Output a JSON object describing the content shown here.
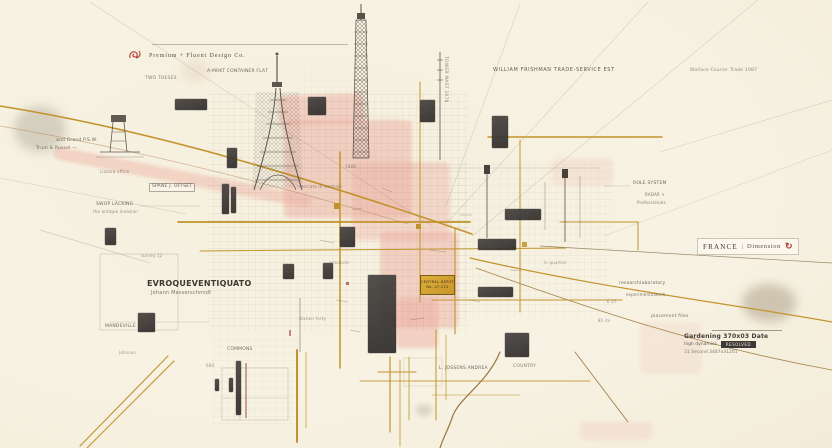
{
  "colors": {
    "paper": "#f7f1e1",
    "gold": "#c2932c",
    "gold_bright": "#d9a62e",
    "pink": "#eeb0a4",
    "charcoal": "#3c3936",
    "ink": "#4a443c",
    "red": "#b23a32"
  },
  "legend": {
    "text": "Premium + Fluent Design Co.",
    "icon": "rose-compass"
  },
  "region_tag": {
    "name": "FRANCE",
    "separator": "|",
    "label": "Dimension",
    "icon_glyph": "↻"
  },
  "plaque": {
    "line1": "CENTRAL DEPOT",
    "line2": "No. 47-212"
  },
  "info_block": {
    "title": "Gardening 370x03 Date",
    "subtitle": "high dynamics",
    "badge": "RESOLVED",
    "footer": "31 Second 3487x31201"
  },
  "labels": [
    {
      "text": "A-MRKT CONTAINER FLAT",
      "x": 207,
      "y": 70,
      "fs": 4.5,
      "op": 0.8
    },
    {
      "text": "TWO THESES",
      "x": 145,
      "y": 77,
      "fs": 4.5,
      "op": 0.65
    },
    {
      "text": "and Grand P.S.W.",
      "x": 56,
      "y": 139,
      "fs": 4.5,
      "op": 0.8
    },
    {
      "text": "Trum & Russel —",
      "x": 36,
      "y": 147,
      "fs": 4.5,
      "op": 0.75
    },
    {
      "text": "Lizzard office",
      "x": 100,
      "y": 170,
      "fs": 4,
      "op": 0.6
    },
    {
      "text": "SPANE J. OFFSET",
      "x": 149,
      "y": 183,
      "fs": 4.5,
      "op": 0.85,
      "boxed": true
    },
    {
      "text": "SWOP LACKING",
      "x": 96,
      "y": 203,
      "fs": 4.5,
      "op": 0.8
    },
    {
      "text": "the antique invasion",
      "x": 93,
      "y": 210,
      "fs": 4,
      "op": 0.6
    },
    {
      "text": "WILLIAM FRISHMAN TRADE-SERVICE EST",
      "x": 493,
      "y": 68,
      "fs": 5,
      "ls": 0.6,
      "op": 0.85
    },
    {
      "text": "Wallace Courier Trade 1987",
      "x": 690,
      "y": 69,
      "fs": 4.5,
      "op": 0.6
    },
    {
      "text": "ROLE SYSTEM",
      "x": 633,
      "y": 182,
      "fs": 4.5,
      "op": 0.8
    },
    {
      "text": "RADAR +",
      "x": 645,
      "y": 193,
      "fs": 4,
      "op": 0.7
    },
    {
      "text": "Professionals",
      "x": 637,
      "y": 201,
      "fs": 4,
      "op": 0.65
    },
    {
      "text": "EVROQUEVENTIQUATO",
      "x": 147,
      "y": 280,
      "fs": 8,
      "bold": true,
      "ls": 0.2,
      "color": "#3e3832"
    },
    {
      "text": "Johann Messerschmidt",
      "x": 151,
      "y": 291,
      "fs": 5,
      "op": 0.7
    },
    {
      "text": "survey 12",
      "x": 141,
      "y": 254,
      "fs": 4,
      "op": 0.55
    },
    {
      "text": "MANDEVILLE ST",
      "x": 105,
      "y": 325,
      "fs": 4.5,
      "op": 0.8
    },
    {
      "text": "Johnson",
      "x": 119,
      "y": 351,
      "fs": 4,
      "op": 0.5
    },
    {
      "text": "COMMONS",
      "x": 227,
      "y": 348,
      "fs": 4.5,
      "op": 0.75
    },
    {
      "text": "600",
      "x": 206,
      "y": 364,
      "fs": 4,
      "op": 0.55
    },
    {
      "text": "L. JOSSENS ANDREA",
      "x": 439,
      "y": 367,
      "fs": 4.5,
      "op": 0.8
    },
    {
      "text": "COUNTRY",
      "x": 513,
      "y": 365,
      "fs": 4.5,
      "op": 0.65
    },
    {
      "text": "researchlaboratory",
      "x": 619,
      "y": 282,
      "fs": 4.5,
      "op": 0.8
    },
    {
      "text": "experimentalwork",
      "x": 626,
      "y": 293,
      "fs": 4,
      "op": 0.7
    },
    {
      "text": "E 27",
      "x": 607,
      "y": 300,
      "fs": 4,
      "op": 0.55
    },
    {
      "text": "placement files",
      "x": 651,
      "y": 315,
      "fs": 4.5,
      "op": 0.75
    },
    {
      "text": "81 mi",
      "x": 598,
      "y": 319,
      "fs": 4,
      "op": 0.55
    },
    {
      "text": "TOWER MAST 1978",
      "x": 447,
      "y": 56,
      "fs": 4.5,
      "rot": 90,
      "op": 0.6
    },
    {
      "text": "mercato di centrale",
      "x": 299,
      "y": 185,
      "fs": 4,
      "op": 0.55
    },
    {
      "text": "armature",
      "x": 329,
      "y": 261,
      "fs": 4,
      "op": 0.5
    },
    {
      "text": "station forty",
      "x": 299,
      "y": 317,
      "fs": 4,
      "op": 0.5
    },
    {
      "text": "le quartier",
      "x": 544,
      "y": 261,
      "fs": 4,
      "op": 0.5
    },
    {
      "text": "1888",
      "x": 345,
      "y": 165,
      "fs": 4,
      "op": 0.55
    }
  ],
  "blocks": [
    {
      "x": 175,
      "y": 99,
      "w": 32,
      "h": 11
    },
    {
      "x": 308,
      "y": 97,
      "w": 18,
      "h": 18
    },
    {
      "x": 420,
      "y": 100,
      "w": 15,
      "h": 22
    },
    {
      "x": 492,
      "y": 116,
      "w": 16,
      "h": 32
    },
    {
      "x": 227,
      "y": 148,
      "w": 10,
      "h": 20
    },
    {
      "x": 222,
      "y": 184,
      "w": 7,
      "h": 30
    },
    {
      "x": 231,
      "y": 187,
      "w": 5,
      "h": 26
    },
    {
      "x": 340,
      "y": 227,
      "w": 15,
      "h": 20
    },
    {
      "x": 505,
      "y": 209,
      "w": 36,
      "h": 11
    },
    {
      "x": 478,
      "y": 239,
      "w": 38,
      "h": 11
    },
    {
      "x": 478,
      "y": 287,
      "w": 35,
      "h": 10
    },
    {
      "x": 283,
      "y": 264,
      "w": 11,
      "h": 15
    },
    {
      "x": 323,
      "y": 263,
      "w": 10,
      "h": 16
    },
    {
      "x": 368,
      "y": 275,
      "w": 28,
      "h": 78
    },
    {
      "x": 505,
      "y": 333,
      "w": 24,
      "h": 24
    },
    {
      "x": 105,
      "y": 228,
      "w": 11,
      "h": 17
    },
    {
      "x": 138,
      "y": 313,
      "w": 17,
      "h": 19
    },
    {
      "x": 236,
      "y": 361,
      "w": 5,
      "h": 54
    },
    {
      "x": 229,
      "y": 378,
      "w": 4,
      "h": 14
    },
    {
      "x": 215,
      "y": 379,
      "w": 4,
      "h": 12
    }
  ],
  "patches": [
    {
      "x": 278,
      "y": 96,
      "w": 86,
      "h": 30,
      "rot": -2,
      "op": 0.5
    },
    {
      "x": 284,
      "y": 120,
      "w": 128,
      "h": 98,
      "rot": 0,
      "op": 0.5
    },
    {
      "x": 352,
      "y": 162,
      "w": 98,
      "h": 78,
      "rot": 0,
      "op": 0.4
    },
    {
      "x": 380,
      "y": 232,
      "w": 78,
      "h": 96,
      "rot": 0,
      "op": 0.5
    },
    {
      "x": 396,
      "y": 298,
      "w": 42,
      "h": 50,
      "rot": 0,
      "op": 0.5
    },
    {
      "x": 55,
      "y": 146,
      "w": 262,
      "h": 13,
      "rot": 11,
      "op": 0.45
    },
    {
      "x": 552,
      "y": 158,
      "w": 62,
      "h": 28,
      "rot": 0,
      "op": 0.18
    },
    {
      "x": 640,
      "y": 322,
      "w": 62,
      "h": 52,
      "rot": 0,
      "op": 0.15
    },
    {
      "x": 580,
      "y": 422,
      "w": 72,
      "h": 18,
      "rot": 0,
      "op": 0.2
    }
  ],
  "stains": [
    {
      "x": 14,
      "y": 106,
      "w": 52,
      "h": 46,
      "color": "#8a8274",
      "op": 0.3,
      "blur": 5
    },
    {
      "x": 742,
      "y": 284,
      "w": 54,
      "h": 38,
      "color": "#7d6a4e",
      "op": 0.32,
      "blur": 5
    },
    {
      "x": 416,
      "y": 404,
      "w": 16,
      "h": 12,
      "color": "#8a8274",
      "op": 0.25,
      "blur": 3
    },
    {
      "x": 180,
      "y": 60,
      "w": 30,
      "h": 22,
      "color": "#c9a38e",
      "op": 0.18,
      "blur": 5
    }
  ]
}
